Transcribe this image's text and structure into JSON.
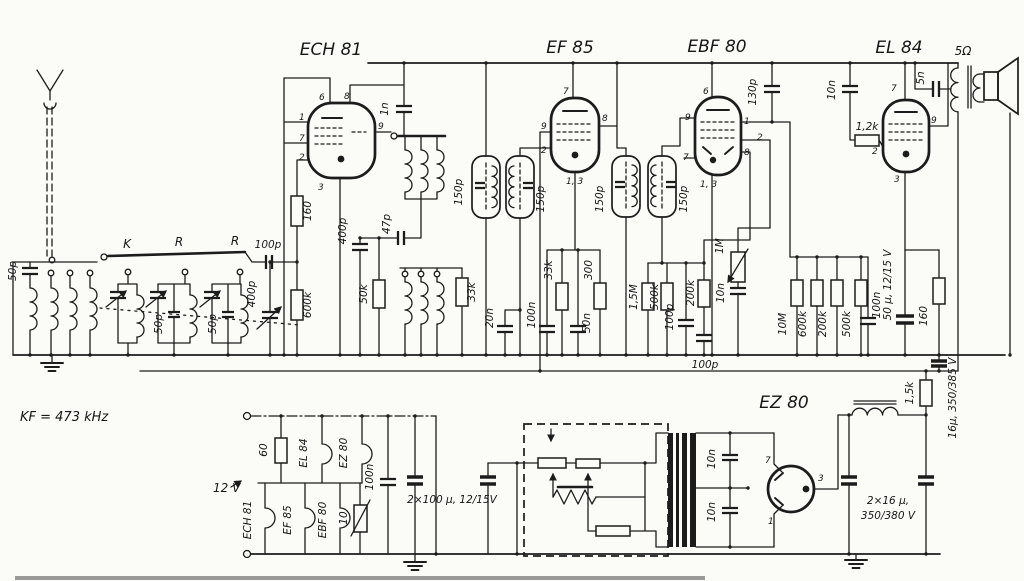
{
  "tubes": {
    "v1": "ECH 81",
    "v2": "EF 85",
    "v3": "EBF 80",
    "v4": "EL 84",
    "v5": "EZ 80"
  },
  "pins": {
    "p1": "1",
    "p2": "2",
    "p3": "3",
    "p6": "6",
    "p7": "7",
    "p8": "8",
    "p9": "9",
    "p13": "1, 3"
  },
  "front_end": {
    "ant_cap": "50p",
    "band_k": "K",
    "band_r1": "R",
    "band_r2": "R",
    "trim2": "50p",
    "trim3": "50p"
  },
  "oscillator": {
    "c100p": "100p",
    "c400p_trim": "400p",
    "c400p_pad": "400p",
    "r160": "160",
    "r600k": "600k",
    "c47p": "47p",
    "r50k": "50k",
    "r33k": "33k",
    "c1n": "1n"
  },
  "if1": {
    "c1": "150p",
    "c2": "150p"
  },
  "if2": {
    "c1": "150p",
    "c2": "150p"
  },
  "ef85_net": {
    "c20n": "20n",
    "c100n": "100n",
    "c50n": "50n",
    "r33k": "33k",
    "r300": "300"
  },
  "detector": {
    "r1m5": "1,5M",
    "r500k": "500k",
    "r200k": "200k",
    "c100p": "100p",
    "c10n": "10n",
    "pot": "1M",
    "c100p_bus": "100p"
  },
  "af": {
    "c130p": "130p",
    "c10n": "10n",
    "r1k2": "1,2k",
    "c5n": "5n",
    "spk": "5Ω"
  },
  "divider": {
    "r10m": "10M",
    "r600k": "600k",
    "r200k": "200k",
    "r500k": "500k",
    "c100n": "100n"
  },
  "el84_cathode": {
    "c50u": "50 μ, 12/15 V",
    "r160": "160"
  },
  "psu": {
    "c16u": "16μ, 350/385 V",
    "r1k5": "1,5k",
    "c2x16a": "2×16 μ,",
    "c2x16b": "350/380 V",
    "c10n_1": "10n",
    "c10n_2": "10n"
  },
  "heaters": {
    "r60": "60",
    "r10": "10",
    "c100n": "100n",
    "c2x100": "2×100 μ, 12/15V",
    "h1": "ECH 81",
    "h2": "EF 85",
    "h3": "EBF 80",
    "h4": "EL 84",
    "h5": "EZ 80"
  },
  "notes": {
    "kf": "KF = 473 kHz",
    "supply": "12 V"
  }
}
